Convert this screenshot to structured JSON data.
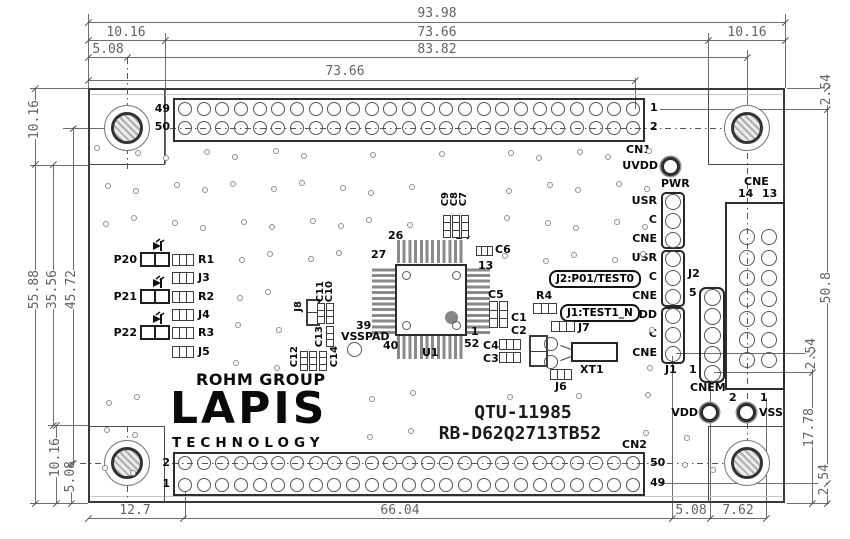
{
  "colors": {
    "drawing_line": "#3a3a3a",
    "dimension": "#636363",
    "silkscreen": "#0a0a0a",
    "hatch": "#aeaeae"
  },
  "dims": {
    "top": {
      "total": "93.98",
      "row2_left": "10.16",
      "row2_mid": "73.66",
      "row2_right": "10.16",
      "row3_left": "5.08",
      "row3_mid": "83.82",
      "row4": "73.66"
    },
    "left": {
      "top": "10.16",
      "height": "55.88",
      "inner": "35.56",
      "holes": "45.72",
      "bottom": "10.16",
      "bottom_inner": "5.08"
    },
    "right": {
      "top": "2.54",
      "span": "50.8",
      "mid": "2.54",
      "lower": "17.78",
      "bottom": "2.54"
    },
    "bottom": {
      "d1": "12.7",
      "d2": "66.04",
      "d3": "5.08",
      "d4": "7.62"
    }
  },
  "connectors": {
    "cn1": {
      "label": "CN1",
      "pin_tl": "49",
      "pin_bl": "50",
      "pin_tr": "1",
      "pin_br": "2"
    },
    "cn2": {
      "label": "CN2",
      "pin_tl": "2",
      "pin_bl": "1",
      "pin_tr": "50",
      "pin_br": "49"
    },
    "cne": {
      "label": "CNE",
      "col_left": "14",
      "col_right": "13"
    },
    "cnem": {
      "label": "CNEM",
      "pin_top": "5",
      "pin_bottom": "1"
    }
  },
  "headers": {
    "pwr_label": "PWR",
    "j2_label": "J2",
    "j1_label": "J1",
    "pins": [
      "USR",
      "C",
      "CNE",
      "USR",
      "C",
      "CNE",
      "VDD",
      "C",
      "CNE"
    ]
  },
  "testpoints": {
    "uvdd": "UVDD",
    "vdd": "VDD",
    "vss": "VSS",
    "vdd_num": "2",
    "vss_num": "1"
  },
  "callouts": {
    "j2": "J2:P01/TEST0",
    "j1": "J1:TEST1_N"
  },
  "left_block": {
    "ports": [
      "P20",
      "P21",
      "P22"
    ],
    "refs": [
      "R1",
      "J3",
      "R2",
      "J4",
      "R3",
      "J5"
    ]
  },
  "ic": {
    "ref": "U1",
    "pad": "VSSPAD",
    "pin26": "26",
    "pin14": "14",
    "pin27": "27",
    "pin13": "13",
    "pin39": "39",
    "pin1": "1",
    "pin40": "40",
    "pin52": "52"
  },
  "passives": {
    "c9": "C9",
    "c8": "C8",
    "c7": "C7",
    "c6": "C6",
    "c5": "C5",
    "c1": "C1",
    "c2": "C2",
    "c4": "C4",
    "c3": "C3",
    "c11": "C11",
    "c10": "C10",
    "c13": "C13",
    "c12": "C12",
    "c14": "C14",
    "j8": "J8",
    "r4": "R4",
    "j7": "J7",
    "j6": "J6",
    "xt1": "XT1"
  },
  "branding": {
    "group": "ROHM GROUP",
    "logo": "LAPIS",
    "logo_sub": "TECHNOLOGY",
    "model": "QTU-11985",
    "part": "RB-D62Q2713TB52"
  }
}
